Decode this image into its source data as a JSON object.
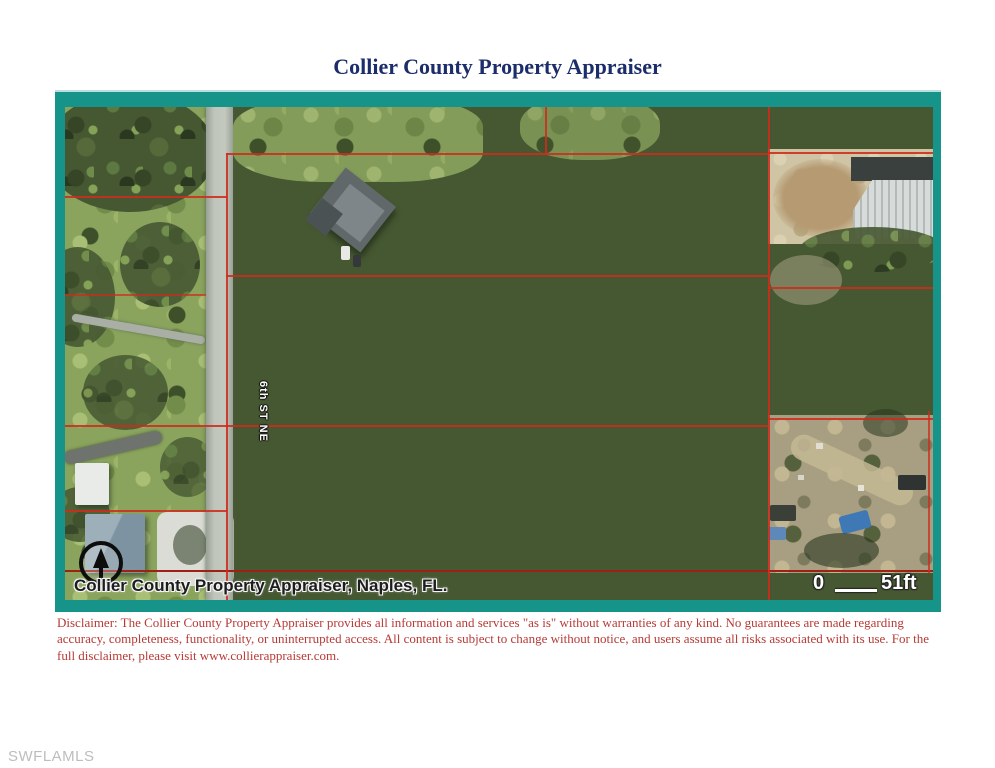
{
  "page": {
    "title": "Collier County Property Appraiser",
    "watermark": "SWFLAMLS"
  },
  "map": {
    "street_label": "6th ST NE",
    "attribution": "Collier County Property Appraiser, Naples, FL.",
    "scale": {
      "start": "0",
      "end": "51ft"
    },
    "colors": {
      "frame_teal": "#17948a",
      "parcel_line_red": "#cf2b1b",
      "title_navy": "#1c2d6b",
      "disclaimer_red": "#b73a35"
    }
  },
  "disclaimer": {
    "text": "Disclaimer: The Collier County Property Appraiser provides all information and services \"as is\" without warranties of any kind. No guarantees are made regarding accuracy, completeness, functionality, or uninterrupted access. All content is subject to change without notice, and users assume all risks associated with its use. For the full disclaimer, please visit www.collierappraiser.com."
  }
}
